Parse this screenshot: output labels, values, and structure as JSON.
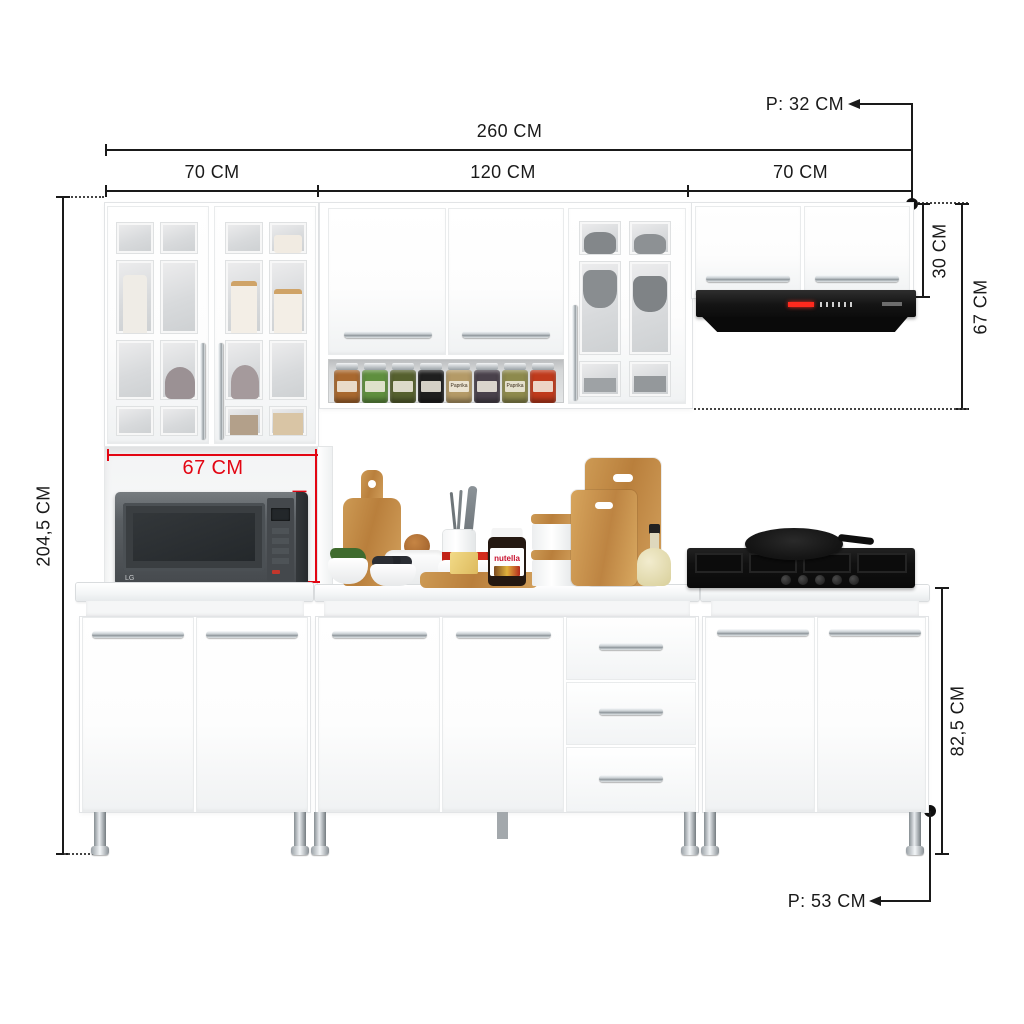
{
  "labels": {
    "total_width": "260 CM",
    "left_section": "70 CM",
    "middle_section": "120 CM",
    "right_section": "70 CM",
    "upper_depth": "P: 32 CM",
    "hood_cabinet_height": "30 CM",
    "upper_cabinet_height": "67 CM",
    "total_height": "204,5 CM",
    "niche_width": "67 CM",
    "niche_height": "39 CM",
    "base_cabinet_height": "82,5 CM",
    "base_depth": "P: 53 CM"
  },
  "appliances": {
    "microwave_brand": "LG",
    "nutella_label": "nutella"
  },
  "spice_jars": [
    {
      "color": "#a8682f",
      "label": ""
    },
    {
      "color": "#5f8f3e",
      "label": ""
    },
    {
      "color": "#55602e",
      "label": ""
    },
    {
      "color": "#1f1f1f",
      "label": ""
    },
    {
      "color": "#b49a67",
      "label": "Paprika"
    },
    {
      "color": "#49414b",
      "label": ""
    },
    {
      "color": "#8d8a4d",
      "label": "Paprika"
    },
    {
      "color": "#bf3a1c",
      "label": ""
    }
  ],
  "colors": {
    "dimension_line": "#1a1a1a",
    "dimension_highlight": "#e30613",
    "cabinet": "#ffffff",
    "cabinet_edge": "#e2e4e6",
    "glass": "#d8dadc",
    "appliance_black": "#141414",
    "microwave_gray": "#565b5f",
    "chrome": "#c9ced2",
    "wood": "#c08b4a"
  }
}
